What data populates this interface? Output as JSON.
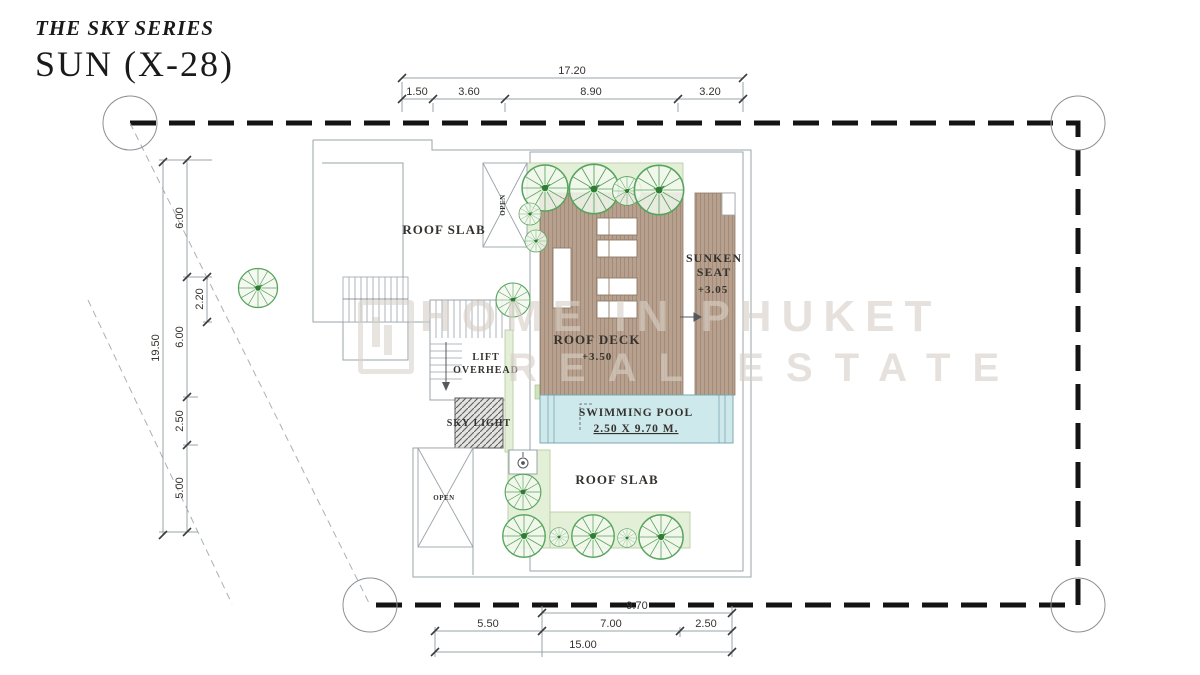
{
  "title": {
    "series": "THE SKY SERIES",
    "model": "SUN (X-28)"
  },
  "watermark": {
    "line1": "HOME IN PHUKET",
    "line2": "REAL ESTATE"
  },
  "plan": {
    "areas": {
      "roof_slab_upper": "ROOF SLAB",
      "roof_slab_lower": "ROOF SLAB",
      "roof_deck": {
        "label": "ROOF DECK",
        "level": "+3.50"
      },
      "sunken_seat": {
        "line1": "SUNKEN",
        "line2": "SEAT",
        "level": "+3.05"
      },
      "lift": {
        "line1": "LIFT",
        "line2": "OVERHEAD"
      },
      "sky_light": "SKY LIGHT",
      "swimming_pool": {
        "line1": "SWIMMING POOL",
        "line2": "2.50 X 9.70 M."
      },
      "open_top": "OPEN",
      "open_bottom": "OPEN"
    },
    "dimensions": {
      "top": {
        "total": "17.20",
        "segments": [
          "1.50",
          "3.60",
          "8.90",
          "3.20"
        ]
      },
      "left": {
        "total": "19.50",
        "segments": [
          "6.00",
          "6.00",
          "2.50",
          "5.00"
        ],
        "sub_segment": "2.20"
      },
      "bottom": {
        "pool_width": "9.70",
        "segments": [
          "5.50",
          "7.00",
          "2.50"
        ],
        "total": "15.00"
      }
    }
  },
  "colors": {
    "deck_wood": "#b7a08d",
    "deck_stripe": "#a28b78",
    "pool_water": "#cde9ec",
    "planter_green": "#e3efd6",
    "tree_green": "#56a45c",
    "boundary_black": "#141414",
    "outline_gray": "#9aa3a8",
    "text_dark": "#35322e"
  },
  "icons": {
    "tree": "tree-icon",
    "shower": "shower-icon",
    "stair_arrow": "stair-down-arrow-icon",
    "grid_marker": "grid-circle-icon"
  }
}
